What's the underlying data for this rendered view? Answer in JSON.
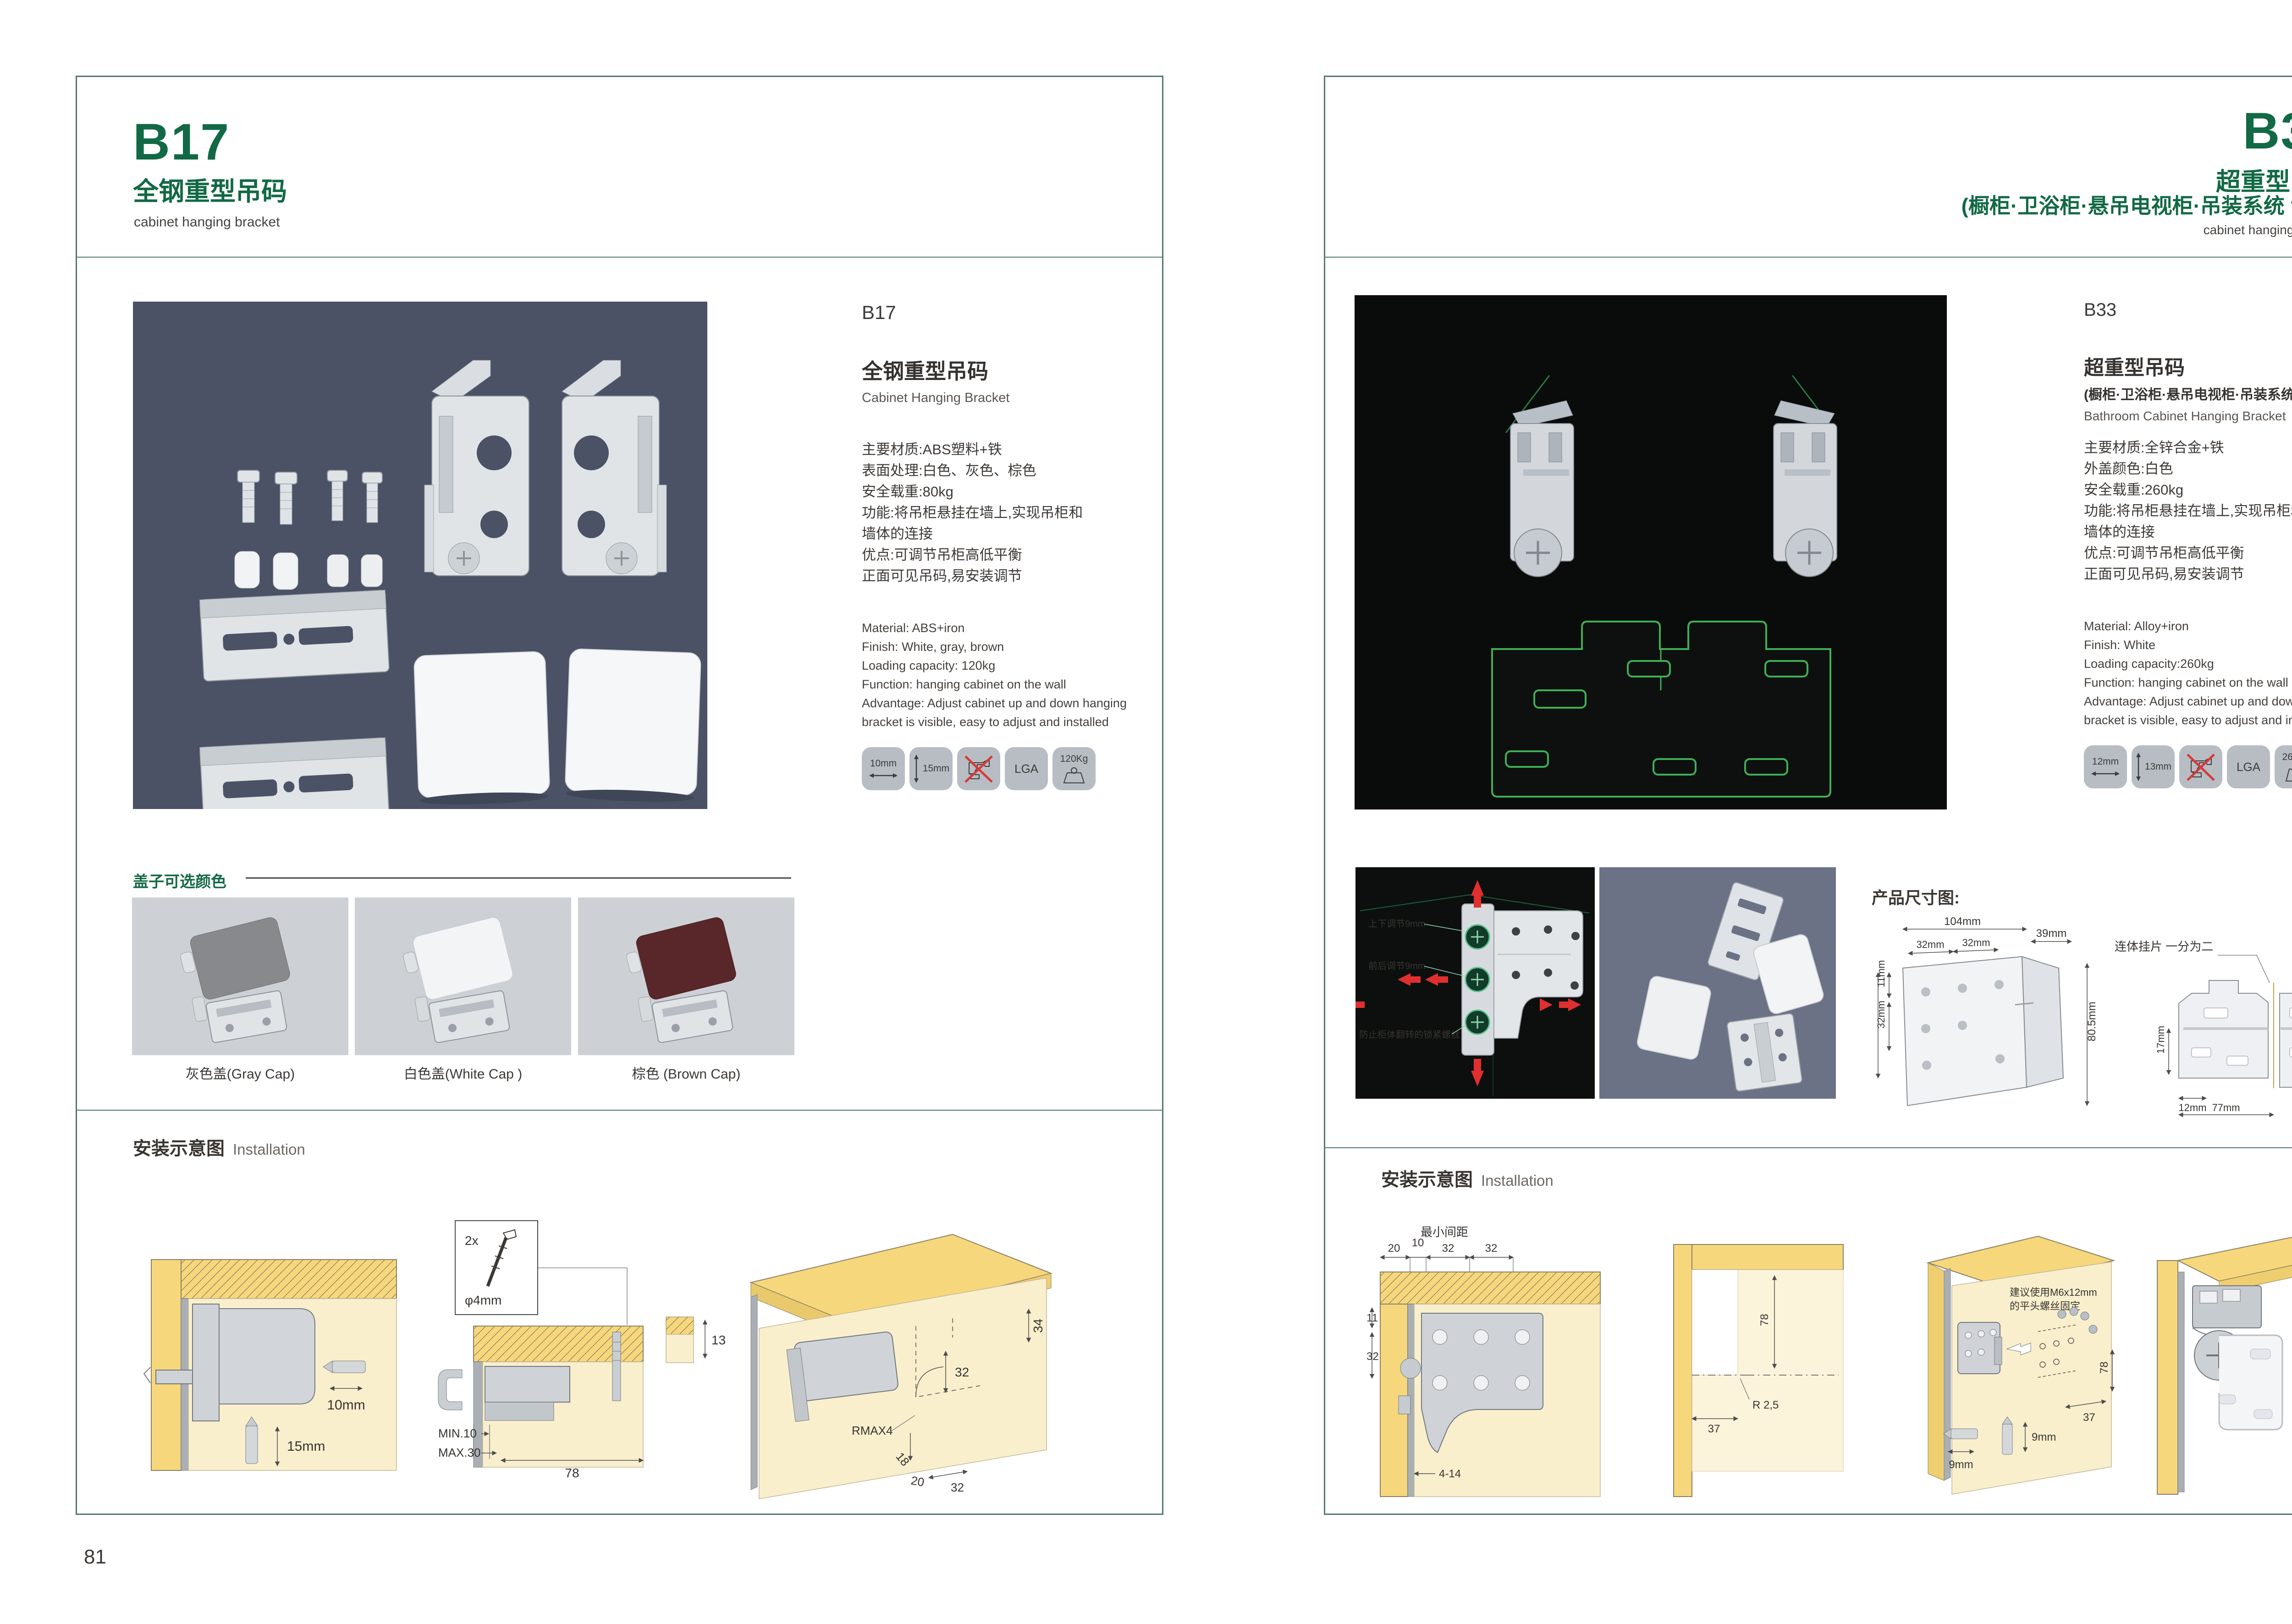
{
  "left_page": {
    "header": {
      "code": "B17",
      "title_cn": "全钢重型吊码",
      "subtitle_en": "cabinet hanging bracket"
    },
    "detail": {
      "code": "B17",
      "name_cn": "全钢重型吊码",
      "name_en": "Cabinet Hanging Bracket",
      "specs_cn": [
        "主要材质:ABS塑料+铁",
        "表面处理:白色、灰色、棕色",
        "安全载重:80kg",
        "功能:将吊柜悬挂在墙上,实现吊柜和",
        "墙体的连接",
        "优点:可调节吊柜高低平衡",
        "正面可见吊码,易安装调节"
      ],
      "specs_en": [
        "Material: ABS+iron",
        "Finish: White, gray, brown",
        "Loading capacity: 120kg",
        "Function: hanging cabinet on the wall",
        "Advantage: Adjust cabinet up and down hanging",
        "bracket is visible, easy to adjust and installed"
      ]
    },
    "icons": {
      "width": "10mm",
      "height": "15mm",
      "no_drill": "no-drill-icon",
      "cert": "LGA",
      "load": "120Kg"
    },
    "caps": {
      "header": "盖子可选颜色",
      "items": [
        {
          "label": "灰色盖(Gray Cap)",
          "color": "#87898c"
        },
        {
          "label": "白色盖(White Cap )",
          "color": "#f3f4f6"
        },
        {
          "label": "棕色 (Brown Cap)",
          "color": "#59262a"
        }
      ]
    },
    "installation": {
      "title_cn": "安装示意图",
      "title_en": "Installation",
      "d1": {
        "dim1": "10mm",
        "dim2": "15mm"
      },
      "d2": {
        "qty": "2x",
        "screw": "φ4mm",
        "min": "MIN.10",
        "max": "MAX.30",
        "w": "78"
      },
      "d3": {
        "a": "13",
        "b": "34",
        "c": "32",
        "r": "RMAX4",
        "d": "18",
        "e": "20",
        "f": "32"
      }
    },
    "page_number": "81"
  },
  "right_page": {
    "header": {
      "code": "B33",
      "title_cn": "超重型吊码",
      "subtitle_cn": "(橱柜·卫浴柜·悬吊电视柜·吊装系统 专用)",
      "subtitle_en": "cabinet hanging bracket"
    },
    "detail": {
      "code": "B33",
      "name_cn": "超重型吊码",
      "name_cn2": "(橱柜·卫浴柜·悬吊电视柜·吊装系统 专用)",
      "name_en": "Bathroom Cabinet Hanging Bracket",
      "specs_cn": [
        "主要材质:全锌合金+铁",
        "外盖颜色:白色",
        "安全载重:260kg",
        "功能:将吊柜悬挂在墙上,实现吊柜和",
        "墙体的连接",
        "优点:可调节吊柜高低平衡",
        "正面可见吊码,易安装调节"
      ],
      "specs_en": [
        "Material: Alloy+iron",
        "Finish: White",
        "Loading capacity:260kg",
        "Function: hanging cabinet on the wall",
        "Advantage: Adjust cabinet up and down hanging",
        "bracket is visible, easy to adjust and installed"
      ]
    },
    "icons": {
      "width": "12mm",
      "height": "13mm",
      "no_drill": "no-drill-icon",
      "cert": "LGA",
      "load": "260Kg"
    },
    "annotated": {
      "l1": "上下调节9mm",
      "l2": "前后调节9mm",
      "l3": "防止柜体翻转的锁紧螺丝"
    },
    "dims": {
      "title": "产品尺寸图:",
      "left": {
        "top": "104mm",
        "t1": "32mm",
        "t2": "32mm",
        "side": "39mm",
        "h": "80.5mm",
        "l1": "11mm",
        "l2": "32mm",
        "l3": "51mm"
      },
      "right": {
        "label": "连体挂片 一分为二",
        "a": "55mm",
        "b": "39mm",
        "c": "55mm",
        "d": "8mm",
        "e": "17mm",
        "f": "12mm",
        "g": "63mm",
        "h": "77mm"
      }
    },
    "installation": {
      "title_cn": "安装示意图",
      "title_en": "Installation",
      "d1": {
        "lbl": "最小间距",
        "a": "20",
        "b": "10",
        "c": "32",
        "d": "32",
        "e": "11",
        "f": "32",
        "g": "4-14"
      },
      "d2": {
        "a": "78",
        "b": "R 2,5",
        "c": "37"
      },
      "d3": {
        "note1": "建议使用M6x12mm",
        "note2": "的平头螺丝固定",
        "a": "37",
        "b": "78",
        "c": "9mm",
        "d": "9mm"
      }
    },
    "page_number": "82"
  }
}
